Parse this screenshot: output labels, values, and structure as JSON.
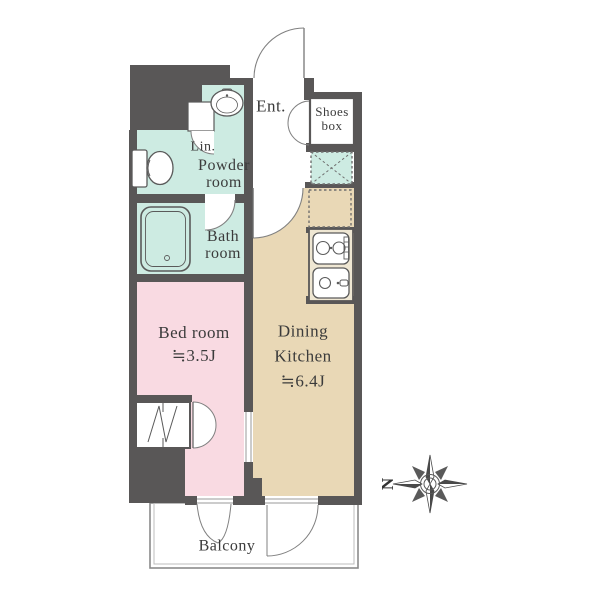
{
  "floorplan": {
    "colors": {
      "wall": "#595757",
      "wet": "#cdebe2",
      "bedroom": "#f9dae2",
      "dk": "#e9d8b6",
      "text": "#3b3b3b"
    },
    "labels": {
      "entrance": "Ent.",
      "shoes_box_line1": "Shoes",
      "shoes_box_line2": "box",
      "linen": "Lin.",
      "powder_line1": "Powder",
      "powder_line2": "room",
      "bath_line1": "Bath",
      "bath_line2": "room",
      "bedroom_name": "Bed room",
      "bedroom_size": "≒3.5J",
      "dk_line1": "Dining",
      "dk_line2": "Kitchen",
      "dk_size": "≒6.4J",
      "balcony": "Balcony",
      "compass_north": "N"
    },
    "icons": {
      "toilet": "toilet-icon",
      "washbasin": "washbasin-icon",
      "bathtub": "bathtub-icon",
      "stove": "stove-icon",
      "kitchen_sink": "kitchen-sink-icon",
      "washer_space": "washer-space-icon",
      "refrigerator_space": "refrigerator-space-icon",
      "closet": "closet-hanger-icon",
      "compass": "compass-rose-icon"
    }
  }
}
